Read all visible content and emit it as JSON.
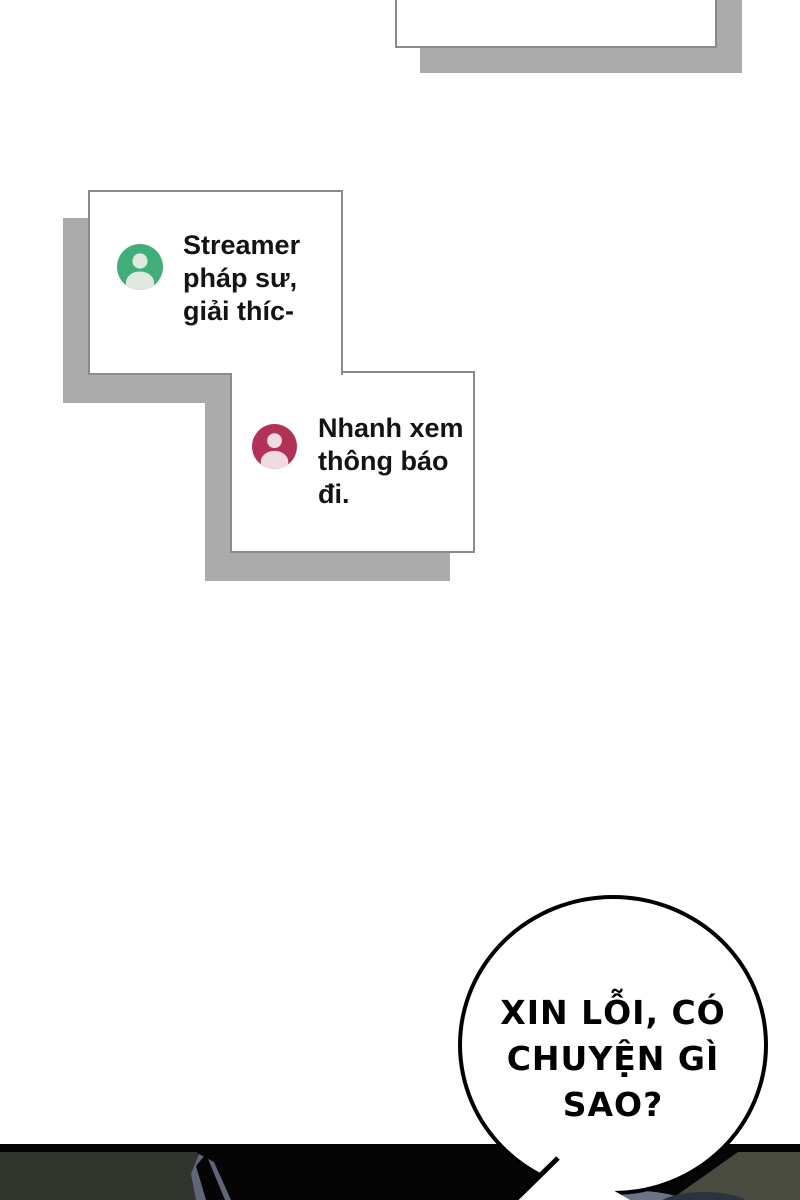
{
  "messages": [
    {
      "avatar_icon": "user-icon",
      "avatar_color": "#3fae78",
      "lines": [
        "Streamer",
        "pháp sư,",
        "giải thíc-"
      ]
    },
    {
      "avatar_icon": "user-icon",
      "avatar_color": "#b23257",
      "lines": [
        "Nhanh xem",
        "thông báo",
        "đi."
      ]
    }
  ],
  "speech_bubble": {
    "lines": [
      "XIN LỖI, CÓ",
      "CHUYỆN GÌ",
      "SAO?"
    ]
  },
  "colors": {
    "background": "#ffffff",
    "box_shadow": "#ababab",
    "box_border": "#8a8a8a",
    "avatar_green": "#3fae78",
    "avatar_green_figure": "#dfe9df",
    "avatar_red": "#b23257",
    "avatar_red_figure": "#f0dbe3",
    "bubble_outline": "#000000",
    "panel_black": "#050505",
    "panel_olive_left": "#32352b",
    "panel_olive_right": "#484b3e",
    "figure_blue_gray": "#5f6678",
    "figure_navy": "#2e3240"
  }
}
